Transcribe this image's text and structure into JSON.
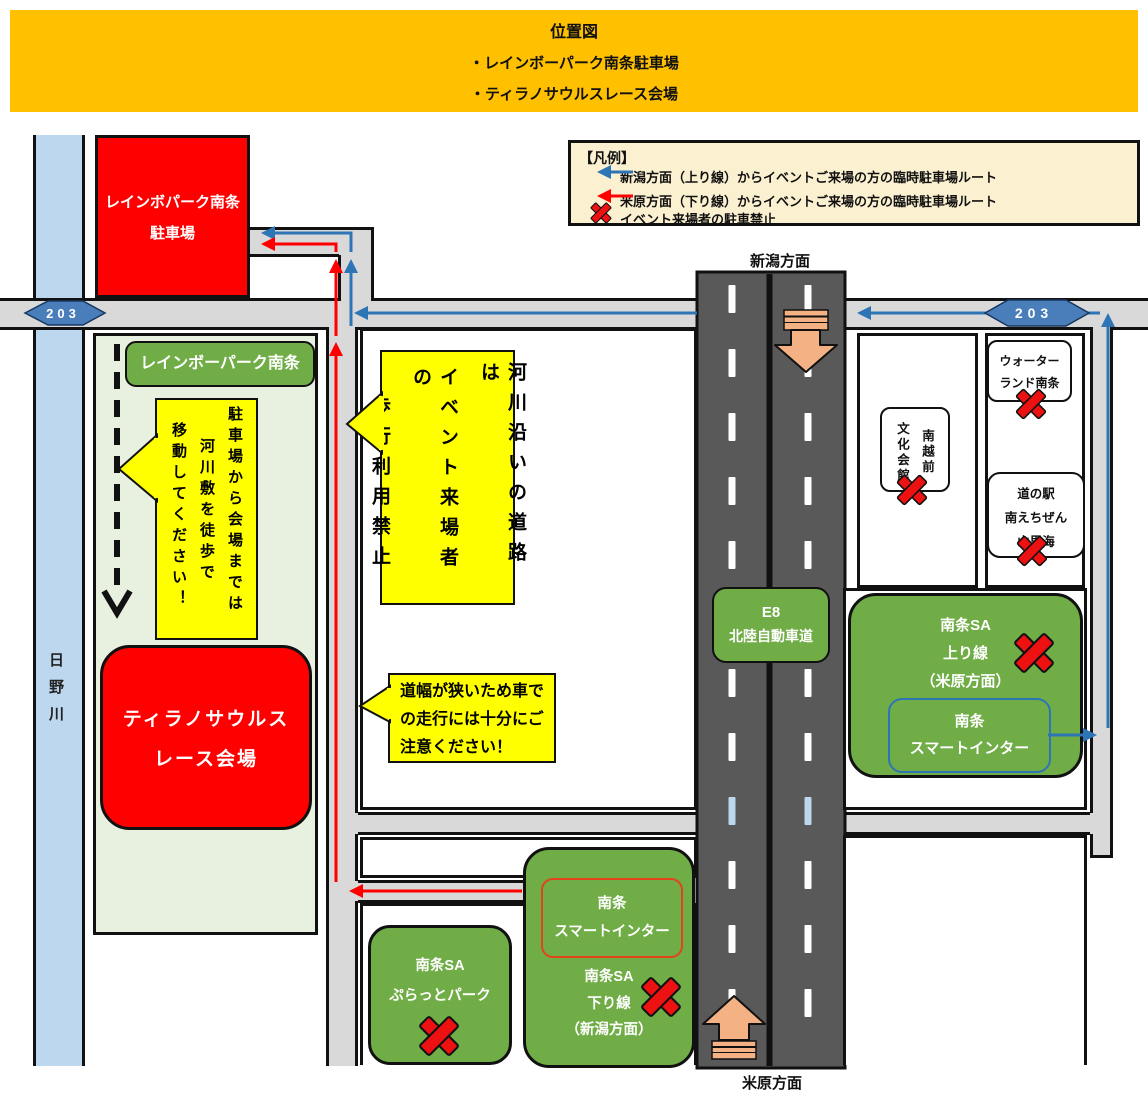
{
  "title": {
    "heading": "位置図",
    "item1": "・レインボーパーク南条駐車場",
    "item2": "・ティラノサウルスレース会場"
  },
  "legend": {
    "heading": "【凡例】",
    "route_blue": "新潟方面（上り線）からイベントご来場の方の臨時駐車場ルート",
    "route_red": "米原方面（下り線）からイベントご来場の方の臨時駐車場ルート",
    "no_parking": "イベント来場者の駐車禁止"
  },
  "map": {
    "river_label": "日野川",
    "route_badge_left": "203",
    "route_badge_right": "203",
    "direction_top": "新潟方面",
    "direction_bottom": "米原方面",
    "parking_lot": {
      "line1": "レインボパーク南条",
      "line2": "駐車場"
    },
    "rainbow_park_label": "レインボーパーク南条",
    "walk_callout": {
      "col1": "駐車場から会場までは",
      "col2": "河川敷を徒歩で",
      "col3": "移動してください！"
    },
    "venue": {
      "line1": "ティラノサウルス",
      "line2": "レース会場"
    },
    "riverside_callout": {
      "col1": "河川沿いの道路は",
      "col2": "イベント来場者の",
      "col3": "歩行利用禁止"
    },
    "narrow_road_callout": {
      "line1": "道幅が狭いため車で",
      "line2": "の走行には十分にご",
      "line3": "注意ください！"
    },
    "expressway": {
      "line1": "E8",
      "line2": "北陸自動車道"
    },
    "bunka_kaikan": {
      "col1": "南越前",
      "col2": "文化会館"
    },
    "waterland": {
      "line1": "ウォーター",
      "line2": "ランド南条"
    },
    "michinoeki": {
      "line1": "道の駅",
      "line2": "南えちぜん",
      "line3": "山里海"
    },
    "sa_up": {
      "line1": "南条SA",
      "line2": "上り線",
      "line3": "（米原方面）"
    },
    "smart_ic_up": {
      "line1": "南条",
      "line2": "スマートインター"
    },
    "sa_down": {
      "line1": "南条SA",
      "line2": "下り線",
      "line3": "（新潟方面）"
    },
    "smart_ic_down": {
      "line1": "南条",
      "line2": "スマートインター"
    },
    "platto_park": {
      "line1": "南条SA",
      "line2": "ぷらっとパーク"
    }
  },
  "colors": {
    "title_bg": "#FFC000",
    "legend_bg": "#FBF0D0",
    "box_red": "#FF0000",
    "box_green": "#70AD47",
    "panel_green": "#E8F0E0",
    "callout_yellow": "#FFFF00",
    "river_blue": "#BDD7EE",
    "road_gray": "#D9D9D9",
    "highway_gray": "#595959",
    "route_blue": "#2E75B6",
    "route_red": "#FF0000",
    "block_arrow_orange": "#F4B183",
    "badge_blue": "#4A7EBB",
    "smart_ic_outline": "#E2441B"
  }
}
